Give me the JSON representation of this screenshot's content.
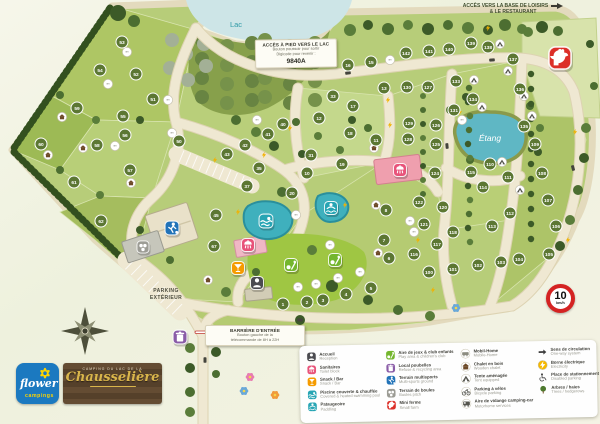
{
  "map": {
    "labels": {
      "lake": "Lac",
      "pond": "Étang"
    },
    "signs": {
      "lake_access": {
        "title": "ACCÈS À PIED VERS LE LAC",
        "line1": "Bouton poussoir pour sortir",
        "line2": "Digicode pour revenir :",
        "code": "9840A"
      },
      "leisure_base": {
        "line1": "ACCÈS VERS LA BASE DE LOISIRS",
        "line2": "& LE RESTAURANT"
      },
      "entrance_barrier": {
        "title": "BARRIÈRE D'ENTRÉE",
        "line1": "Bouton gauche de la",
        "line2": "télécommande de 8H à 22H"
      },
      "outdoor_parking": {
        "line1": "PARKING",
        "line2": "EXTÉRIEUR"
      },
      "speed_limit": {
        "value": "10",
        "unit": "km/h"
      }
    },
    "pitches": [
      [
        53,
        122,
        42
      ],
      [
        54,
        100,
        70
      ],
      [
        52,
        136,
        74
      ],
      [
        51,
        153,
        99
      ],
      [
        59,
        77,
        108
      ],
      [
        55,
        123,
        116
      ],
      [
        56,
        125,
        135
      ],
      [
        58,
        97,
        145
      ],
      [
        50,
        179,
        141
      ],
      [
        60,
        41,
        144
      ],
      [
        57,
        130,
        170
      ],
      [
        61,
        74,
        182
      ],
      [
        62,
        101,
        221
      ],
      [
        45,
        216,
        215
      ],
      [
        67,
        214,
        246
      ],
      [
        40,
        283,
        124
      ],
      [
        41,
        268,
        134
      ],
      [
        42,
        245,
        145
      ],
      [
        43,
        227,
        154
      ],
      [
        35,
        259,
        168
      ],
      [
        37,
        247,
        186
      ],
      [
        20,
        292,
        193
      ],
      [
        33,
        333,
        96
      ],
      [
        17,
        353,
        106
      ],
      [
        12,
        319,
        118
      ],
      [
        18,
        350,
        133
      ],
      [
        11,
        376,
        140
      ],
      [
        31,
        311,
        155
      ],
      [
        19,
        342,
        164
      ],
      [
        10,
        307,
        173
      ],
      [
        16,
        348,
        65
      ],
      [
        15,
        371,
        62
      ],
      [
        13,
        384,
        88
      ],
      [
        142,
        406,
        53
      ],
      [
        141,
        429,
        51
      ],
      [
        140,
        449,
        49
      ],
      [
        139,
        471,
        43
      ],
      [
        138,
        488,
        47
      ],
      [
        137,
        513,
        59
      ],
      [
        136,
        520,
        89
      ],
      [
        135,
        524,
        126
      ],
      [
        134,
        473,
        99
      ],
      [
        133,
        456,
        81
      ],
      [
        131,
        454,
        110
      ],
      [
        130,
        407,
        87
      ],
      [
        127,
        428,
        87
      ],
      [
        129,
        409,
        123
      ],
      [
        126,
        436,
        125
      ],
      [
        128,
        408,
        139
      ],
      [
        125,
        436,
        144
      ],
      [
        124,
        435,
        173
      ],
      [
        122,
        419,
        202
      ],
      [
        120,
        443,
        207
      ],
      [
        121,
        424,
        224
      ],
      [
        118,
        453,
        232
      ],
      [
        117,
        437,
        244
      ],
      [
        116,
        414,
        254
      ],
      [
        100,
        429,
        272
      ],
      [
        101,
        453,
        269
      ],
      [
        102,
        478,
        265
      ],
      [
        103,
        501,
        262
      ],
      [
        104,
        519,
        259
      ],
      [
        105,
        549,
        254
      ],
      [
        106,
        556,
        226
      ],
      [
        107,
        548,
        200
      ],
      [
        108,
        542,
        173
      ],
      [
        109,
        535,
        144
      ],
      [
        110,
        490,
        164
      ],
      [
        115,
        471,
        172
      ],
      [
        111,
        508,
        177
      ],
      [
        114,
        483,
        187
      ],
      [
        112,
        510,
        213
      ],
      [
        113,
        492,
        226
      ],
      [
        8,
        386,
        210
      ],
      [
        7,
        384,
        240
      ],
      [
        6,
        389,
        258
      ],
      [
        5,
        371,
        288
      ],
      [
        4,
        346,
        294
      ],
      [
        3,
        323,
        300
      ],
      [
        2,
        307,
        302
      ],
      [
        1,
        283,
        304
      ]
    ],
    "unit_markers": [
      [
        "mh",
        127,
        52
      ],
      [
        "mh",
        108,
        84
      ],
      [
        "mh",
        168,
        100
      ],
      [
        "mh",
        172,
        133
      ],
      [
        "mh",
        115,
        146
      ],
      [
        "mh",
        257,
        120
      ],
      [
        "mh",
        296,
        215
      ],
      [
        "mh",
        330,
        245
      ],
      [
        "mh",
        298,
        287
      ],
      [
        "mh",
        316,
        284
      ],
      [
        "mh",
        338,
        278
      ],
      [
        "mh",
        360,
        272
      ],
      [
        "mh",
        410,
        221
      ],
      [
        "mh",
        414,
        232
      ],
      [
        "mh",
        390,
        60
      ],
      [
        "mh",
        462,
        120
      ],
      [
        "chalet",
        62,
        117
      ],
      [
        "chalet",
        83,
        148
      ],
      [
        "chalet",
        48,
        155
      ],
      [
        "chalet",
        131,
        183
      ],
      [
        "chalet",
        208,
        280
      ],
      [
        "chalet",
        374,
        148
      ],
      [
        "chalet",
        376,
        205
      ],
      [
        "chalet",
        378,
        253
      ],
      [
        "tent",
        500,
        44
      ],
      [
        "tent",
        508,
        71
      ],
      [
        "tent",
        474,
        80
      ],
      [
        "tent",
        482,
        107
      ],
      [
        "tent",
        524,
        96
      ],
      [
        "tent",
        532,
        116
      ],
      [
        "tent",
        502,
        162
      ],
      [
        "tent",
        520,
        190
      ]
    ],
    "facilities": [
      {
        "name": "reception",
        "icon": "person",
        "color": "#4b4b50",
        "x": 257,
        "y": 283,
        "s": 14
      },
      {
        "name": "toilet-block-1",
        "icon": "shower",
        "color": "#e8537a",
        "x": 248,
        "y": 245,
        "s": 14
      },
      {
        "name": "toilet-block-2",
        "icon": "shower",
        "color": "#e8537a",
        "x": 400,
        "y": 170,
        "s": 14
      },
      {
        "name": "snack-bar",
        "icon": "snack",
        "color": "#f59b00",
        "x": 238,
        "y": 268,
        "s": 14
      },
      {
        "name": "covered-pool",
        "icon": "swim",
        "color": "#27a5b4",
        "x": 266,
        "y": 221,
        "s": 15
      },
      {
        "name": "paddling-pool",
        "icon": "paddling",
        "color": "#27a5b4",
        "x": 331,
        "y": 208,
        "s": 14
      },
      {
        "name": "play-area-1",
        "icon": "play",
        "color": "#74b62d",
        "x": 291,
        "y": 265,
        "s": 14
      },
      {
        "name": "play-area-2",
        "icon": "play",
        "color": "#74b62d",
        "x": 335,
        "y": 260,
        "s": 14
      },
      {
        "name": "refuse-area",
        "icon": "trash",
        "color": "#8a5ca7",
        "x": 180,
        "y": 337,
        "s": 15
      },
      {
        "name": "multisport-ground",
        "icon": "multisport",
        "color": "#2273b8",
        "x": 172,
        "y": 228,
        "s": 15
      },
      {
        "name": "boules-pitch",
        "icon": "boules",
        "color": "#9c9c95",
        "x": 143,
        "y": 247,
        "s": 13
      },
      {
        "name": "mini-farm",
        "icon": "rooster",
        "color": "#dc2f28",
        "x": 560,
        "y": 58,
        "s": 24
      }
    ],
    "electric_points": [
      [
        215,
        160
      ],
      [
        264,
        155
      ],
      [
        290,
        128
      ],
      [
        388,
        100
      ],
      [
        390,
        125
      ],
      [
        460,
        112
      ],
      [
        345,
        205
      ],
      [
        326,
        298
      ],
      [
        433,
        290
      ],
      [
        575,
        132
      ],
      [
        568,
        240
      ],
      [
        418,
        240
      ],
      [
        488,
        28
      ],
      [
        238,
        212
      ]
    ]
  },
  "legend": {
    "columns": [
      [
        {
          "glyph": "person",
          "bg": "square",
          "color": "#4b4b50",
          "fr": "Accueil",
          "en": "Reception"
        },
        {
          "glyph": "shower",
          "bg": "square",
          "color": "#e8537a",
          "fr": "Sanitaires",
          "en": "Toilet block"
        },
        {
          "glyph": "snack",
          "bg": "square",
          "color": "#f59b00",
          "fr": "Snack / Bar",
          "en": "Snack / Bar"
        },
        {
          "glyph": "swim",
          "bg": "square",
          "color": "#27a5b4",
          "fr": "Piscine couverte & chauffée",
          "en": "Covered & heated swimming pool"
        },
        {
          "glyph": "paddling",
          "bg": "square",
          "color": "#27a5b4",
          "fr": "Pataugeoire",
          "en": "Paddling"
        }
      ],
      [
        {
          "glyph": "play",
          "bg": "square",
          "color": "#74b62d",
          "fr": "Aire de jeux & club enfants",
          "en": "Play area & children's club"
        },
        {
          "glyph": "trash",
          "bg": "square",
          "color": "#8a5ca7",
          "fr": "Local poubelles",
          "en": "Refuse & recycling area"
        },
        {
          "glyph": "multisport",
          "bg": "square",
          "color": "#2273b8",
          "fr": "Terrain multisports",
          "en": "Multi-sports ground"
        },
        {
          "glyph": "boules",
          "bg": "square",
          "color": "#9c9c95",
          "fr": "Terrain de boules",
          "en": "Boules pitch"
        },
        {
          "glyph": "rooster",
          "bg": "square",
          "color": "#dc2f28",
          "fr": "Mini ferme",
          "en": "Small farm"
        }
      ],
      [
        {
          "glyph": "mobilhome",
          "bg": "circle",
          "color": "#ffffff",
          "fr": "Mobil-Home",
          "en": "Mobile-Home"
        },
        {
          "glyph": "chalet",
          "bg": "circle",
          "color": "#ffffff",
          "fr": "Chalet en bois",
          "en": "Wooden chalet"
        },
        {
          "glyph": "tent",
          "bg": "circle",
          "color": "#ffffff",
          "fr": "Tente aménagée",
          "en": "Tent equipped"
        },
        {
          "glyph": "bike",
          "bg": "circle",
          "color": "#ffffff",
          "fr": "Parking à vélos",
          "en": "Bicycle parking"
        },
        {
          "glyph": "rv",
          "bg": "circle",
          "color": "#ffffff",
          "fr": "Aire de vidange camping-car",
          "en": "Motorhome services"
        }
      ],
      [
        {
          "glyph": "arrow",
          "bg": "none",
          "color": "",
          "fr": "Sens de circulation",
          "en": "One-way system"
        },
        {
          "glyph": "bolt",
          "bg": "circle",
          "color": "#f6b800",
          "fr": "Borne électrique",
          "en": "Electricity"
        },
        {
          "glyph": "wheelchair",
          "bg": "none",
          "color": "",
          "fr": "Place de stationnement PMR",
          "en": "Disabled parking"
        },
        {
          "glyph": "tree",
          "bg": "none",
          "color": "",
          "fr": "Arbres / haies",
          "en": "Trees / hedgerows"
        }
      ]
    ]
  },
  "logos": {
    "flower": {
      "word1": "flower",
      "word2": "campings"
    },
    "chausseliere": {
      "top": "CAMPING DU LAC DE LA",
      "name": "Chausselière"
    }
  },
  "colors": {
    "pitch_circle": "#5c7733",
    "water_lake": "#cde5e7",
    "water_pond": "#5fb7c4",
    "road": "#efe8d2",
    "site_green": "#b7cd79"
  }
}
